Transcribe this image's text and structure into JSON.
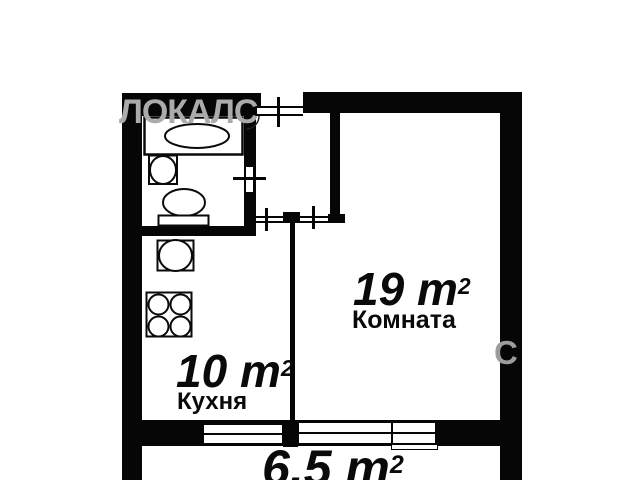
{
  "plan": {
    "colors": {
      "wall": "#060606",
      "watermark": "#ababab",
      "background": "#ffffff"
    },
    "watermarks": {
      "primary": "ЛОКАЛС",
      "secondary": "С"
    },
    "rooms": {
      "living": {
        "name": "Комната",
        "area": "19 m",
        "area_sup": "2"
      },
      "kitchen": {
        "name": "Кухня",
        "area": "10 m",
        "area_sup": "2"
      },
      "balcony": {
        "area": "6.5 m",
        "area_sup": "2"
      }
    },
    "fixture_icons": [
      "bathtub-icon",
      "washbasin-icon",
      "toilet-icon",
      "kitchen-sink-icon",
      "stove-burners-icon"
    ],
    "opening_icons": [
      "entrance-door-icon",
      "bathroom-door-icon",
      "kitchen-doorway-icon",
      "room-doorway-icon"
    ],
    "window_icons": [
      "kitchen-window-icon",
      "room-window-icon"
    ]
  }
}
